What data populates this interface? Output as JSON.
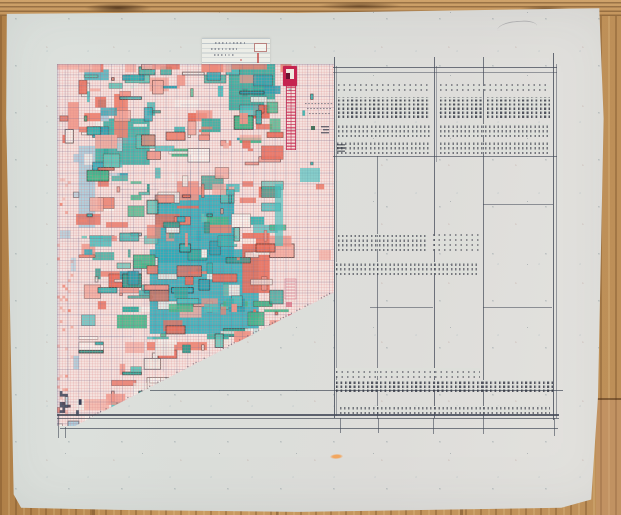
{
  "scene": {
    "description": "Photograph of a large sheet of paper on a wooden table bearing a hand-drawn colored pixel-mosaic grid chart with a diagonal lower edge, a small ruled note slip, a red stamp mark, and a hand-ruled tally table filled with tiny illegible handwriting",
    "aria_label": "Hand-drawn mosaic grid chart and handwritten tally table on paper"
  },
  "palette": {
    "wood_base": "#bf8f57",
    "paper": "#dddfda",
    "note_paper": "#ecede7",
    "ink": "#2e3a50",
    "table_ink": "#454b59",
    "stamp_red": "#c5234f",
    "hatch_red": "#cd375a",
    "orange_smudge": "#f2a258"
  },
  "mosaic": {
    "seed": 7,
    "cols": 101,
    "rows": 133,
    "cell_px": 2.726,
    "background": "#f5e3df",
    "teals": [
      "#2fae9f",
      "#35b7b2",
      "#49c2c0",
      "#2aa3b2",
      "#5ec9ba",
      "#3eb98a",
      "#2f9e8f",
      "#2fb0bd"
    ],
    "salmons": [
      "#ee8370",
      "#f2988a",
      "#e96e5b",
      "#f4b0a4"
    ],
    "pales": [
      "#a9cede",
      "#bcd8e2"
    ],
    "whites": [
      "#f7f4ee",
      "#efece6"
    ],
    "greens": [
      "#3eb98a",
      "#2f9e6f"
    ],
    "grid_pink": "rgba(221,140,140,0.42)",
    "grid_blue": "rgba(90,110,155,0.30)",
    "diagonal_edge": "staircase cut from lower-left to mid-right",
    "dominant": "teal and cyan patches with salmon clusters on pale pink graph grid"
  },
  "note_slip": {
    "ruled_lines": 6,
    "scribble_rows": 3,
    "has_sketch_rectangle": true,
    "has_red_tick": true,
    "content": "illegible pencil scribbles"
  },
  "stamp": {
    "style": "solid red square with white inset window and dark corner glyph"
  },
  "hatch_column": {
    "style": "narrow vertical column of red horizontal hatch marks below the stamp"
  },
  "table": {
    "columns": 3,
    "handwriting_bands": 15,
    "content": "rows of tiny illegible handwriting and tally dashes",
    "has_top_double_border": true,
    "has_bottom_double_border": true
  },
  "marks": {
    "orange_smudge": true,
    "scuff_line": true
  }
}
